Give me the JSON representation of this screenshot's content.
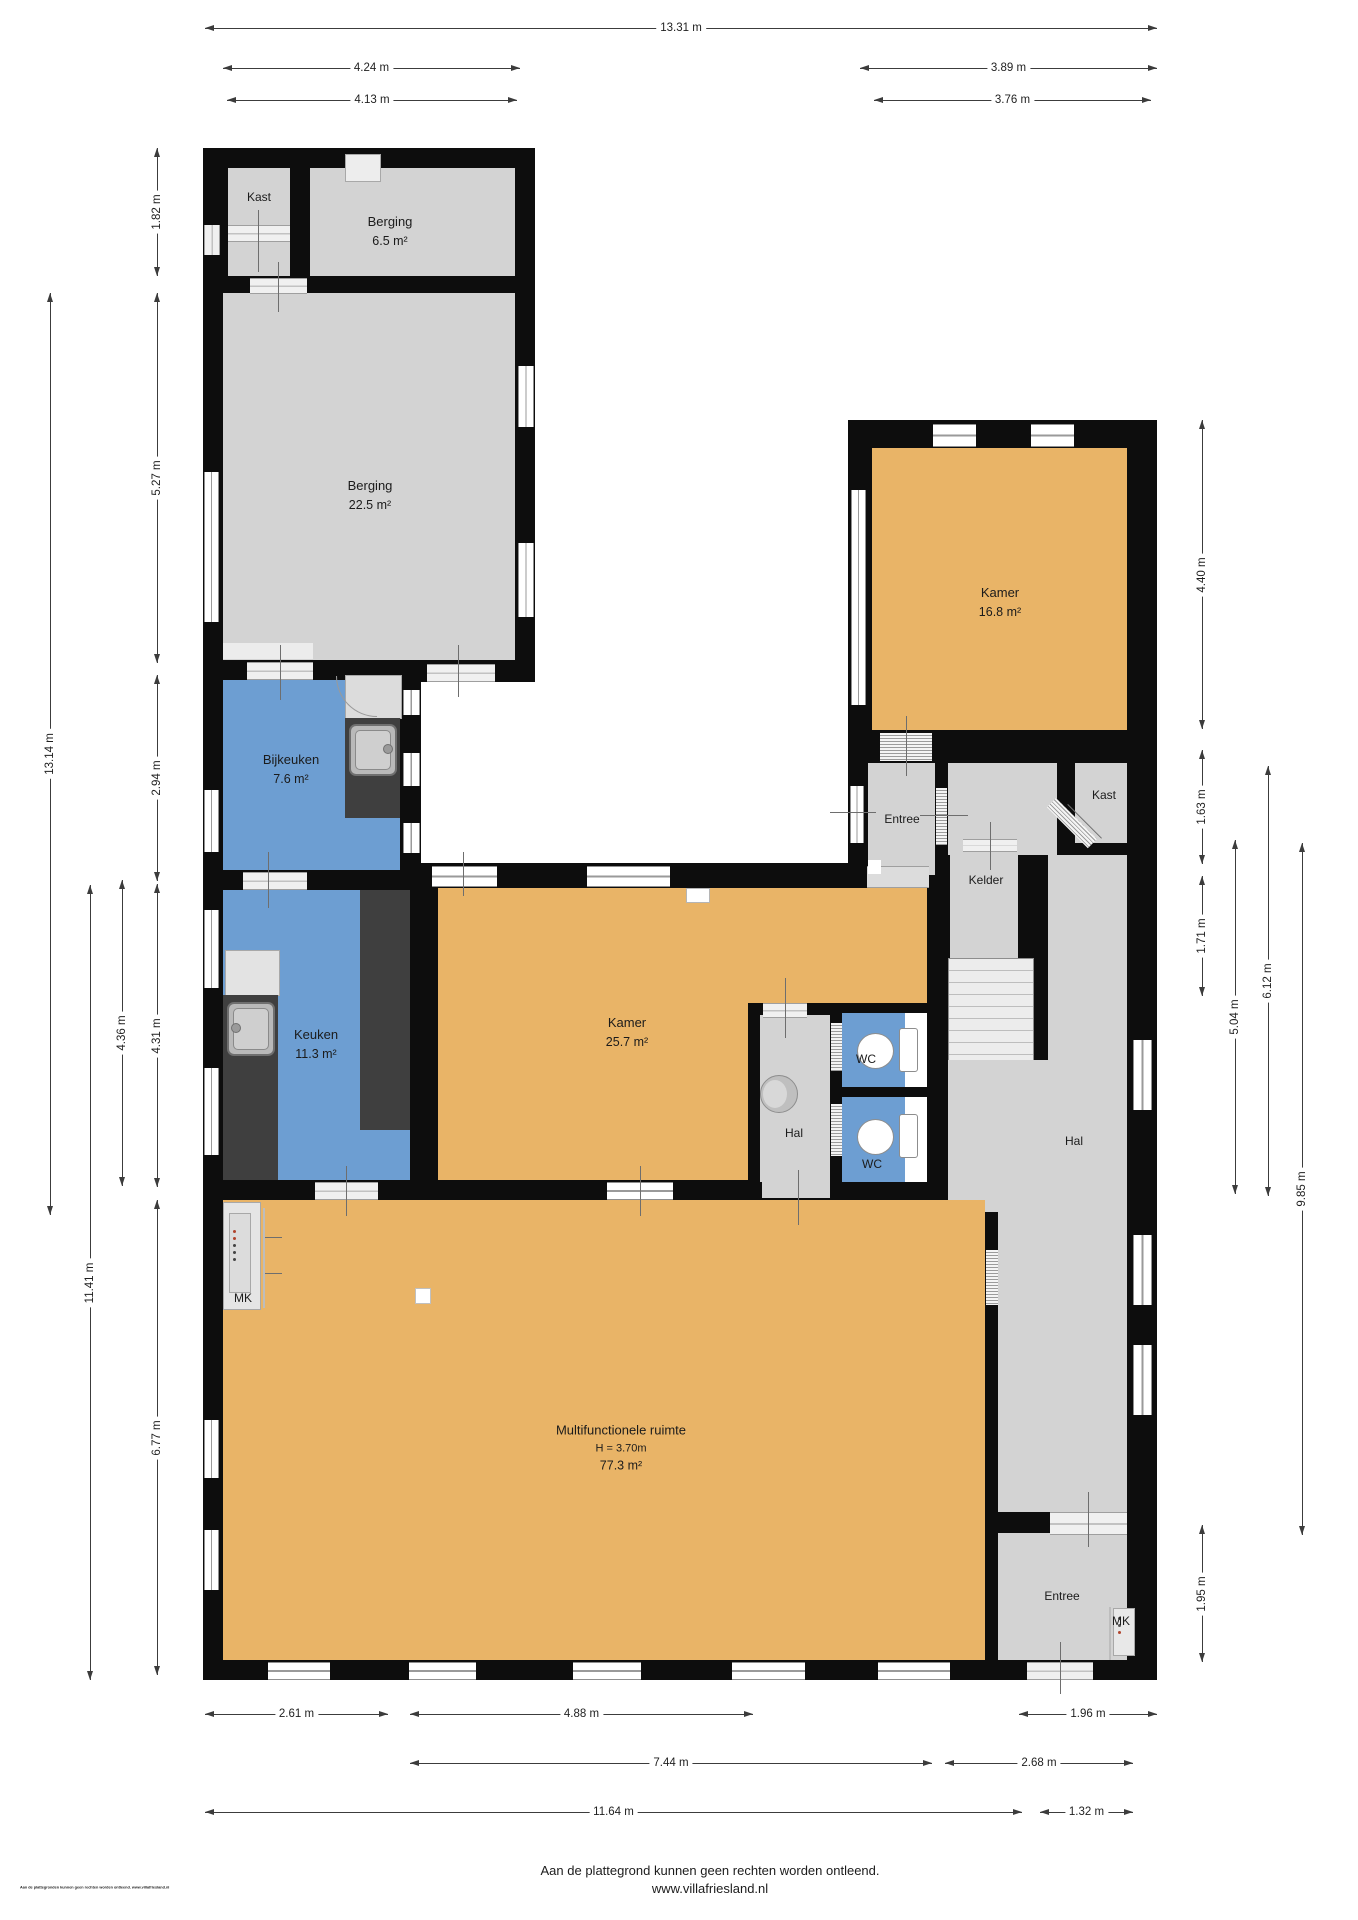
{
  "title": "Floor plan (plattegrond) begane grond",
  "rooms": {
    "kast_tl": {
      "name": "Kast"
    },
    "berging_small": {
      "name": "Berging",
      "area": "6.5 m²"
    },
    "berging_large": {
      "name": "Berging",
      "area": "22.5 m²"
    },
    "kamer_right": {
      "name": "Kamer",
      "area": "16.8 m²"
    },
    "bijkeuken": {
      "name": "Bijkeuken",
      "area": "7.6 m²"
    },
    "entree_top": {
      "name": "Entree"
    },
    "kast_right": {
      "name": "Kast"
    },
    "kelder": {
      "name": "Kelder"
    },
    "keuken": {
      "name": "Keuken",
      "area": "11.3 m²"
    },
    "kamer_main": {
      "name": "Kamer",
      "area": "25.7 m²"
    },
    "wc_top": {
      "name": "WC"
    },
    "wc_bottom": {
      "name": "WC"
    },
    "hal_small": {
      "name": "Hal"
    },
    "hal_corridor": {
      "name": "Hal"
    },
    "mk_left": {
      "name": "MK"
    },
    "multi": {
      "name": "Multifunctionele ruimte",
      "height": "H = 3.70m",
      "area": "77.3 m²"
    },
    "entree_bottom": {
      "name": "Entree"
    },
    "mk_right": {
      "name": "MK"
    }
  },
  "dims": {
    "top_total": "13.31 m",
    "top_left_outer": "4.24 m",
    "top_left_inner": "4.13 m",
    "top_right_outer": "3.89 m",
    "top_right_inner": "3.76 m",
    "left_total": "13.14 m",
    "left_lower": "11.41 m",
    "left_a": "1.82 m",
    "left_b": "5.27 m",
    "left_c": "2.94 m",
    "left_d": "4.36 m",
    "left_e": "4.31 m",
    "left_f": "6.77 m",
    "right_a": "4.40 m",
    "right_b": "1.63 m",
    "right_c": "1.71 m",
    "right_d": "5.04 m",
    "right_e": "6.12 m",
    "right_f": "9.85 m",
    "right_g": "1.95 m",
    "bottom_a": "2.61 m",
    "bottom_b": "4.88 m",
    "bottom_c": "1.96 m",
    "bottom_d": "7.44 m",
    "bottom_e": "2.68 m",
    "bottom_f": "11.64 m",
    "bottom_g": "1.32 m"
  },
  "footer": {
    "line1": "Aan de plattegrond kunnen geen rechten worden ontleend.",
    "line2": "www.villafriesland.nl",
    "micro": "Aan de plattegronden kunnen geen rechten worden ontleend. www.villafriesland.nl"
  },
  "colors": {
    "wall": "#0d0d0d",
    "room_gray": "#d3d3d3",
    "room_orange": "#e9b467",
    "room_blue": "#6d9ed2",
    "furniture_dark": "#3f3f3f"
  }
}
